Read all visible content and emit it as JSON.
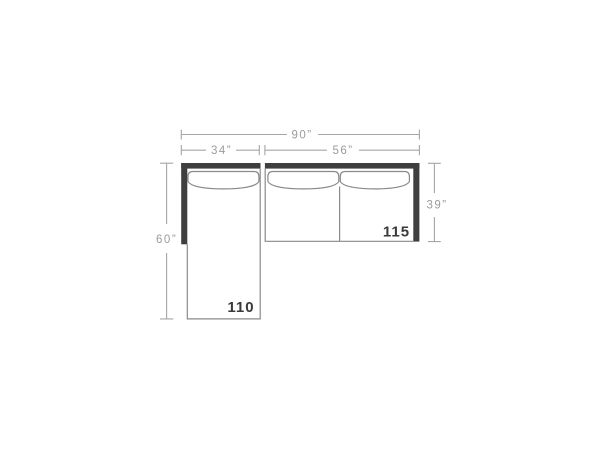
{
  "diagram": {
    "kind": "sectional-sofa-top-view-dimension-diagram",
    "colors": {
      "background": "#ffffff",
      "frame": "#3f3f3f",
      "outline": "#8a8a8a",
      "dimension_line": "#a6a6a6",
      "dimension_text": "#9b9b9b",
      "piece_label_text": "#3a3a3a"
    },
    "dimensions": {
      "overall_width": "90”",
      "chaise_width": "34”",
      "sofa_width": "56”",
      "chaise_length": "60”",
      "sofa_depth": "39”"
    },
    "piece_labels": {
      "chaise": "110",
      "sofa": "115"
    }
  }
}
